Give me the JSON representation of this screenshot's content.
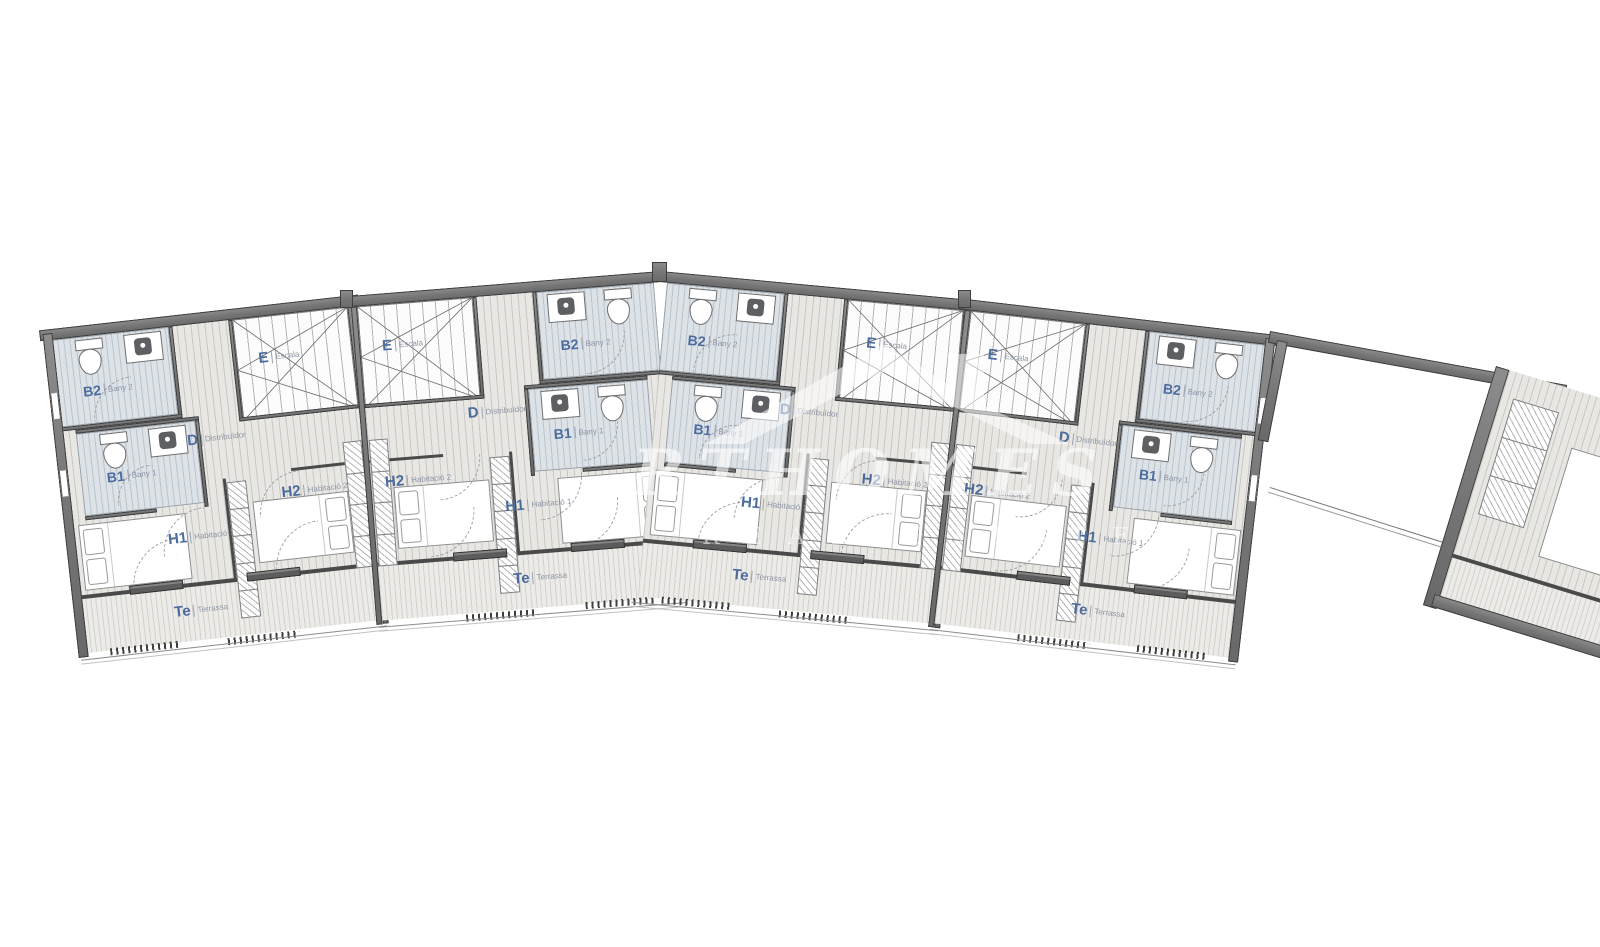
{
  "plan": {
    "type": "floor-plan",
    "language": "Catalan",
    "description": "First-floor plan of a curved row of 4 mirrored terraced houses plus a partially visible fifth unit at far right"
  },
  "watermark": {
    "logo": "house-roof-icon",
    "line1": "RTHOMES",
    "line2": "REAL ESTATE"
  },
  "colors": {
    "background": "#ffffff",
    "wall": "#757575",
    "wall_edge": "#3e3e3e",
    "floor": "#e8e7e3",
    "bathroom_floor": "#dde2e7",
    "terrace_floor": "#edebe7",
    "stairs_floor": "#fcfcfc",
    "label_code": "#4c6c9d",
    "label_name": "#8d95a5"
  },
  "units": [
    {
      "id": "unit-1",
      "mirrored": false,
      "rooms": {
        "b2": {
          "code": "B2",
          "name": "Bany 2"
        },
        "b1": {
          "code": "B1",
          "name": "Bany 1"
        },
        "d": {
          "code": "D",
          "name": "Distribuïdor"
        },
        "e": {
          "code": "E",
          "name": "Escala"
        },
        "h1": {
          "code": "H1",
          "name": "Habitació 1"
        },
        "h2": {
          "code": "H2",
          "name": "Habitació 2"
        },
        "te": {
          "code": "Te",
          "name": "Terrassa"
        }
      }
    },
    {
      "id": "unit-2",
      "mirrored": true,
      "rooms": {
        "b2": {
          "code": "B2",
          "name": "Bany 2"
        },
        "b1": {
          "code": "B1",
          "name": "Bany 1"
        },
        "d": {
          "code": "D",
          "name": "Distribuïdor"
        },
        "e": {
          "code": "E",
          "name": "Escala"
        },
        "h1": {
          "code": "H1",
          "name": "Habitació 1"
        },
        "h2": {
          "code": "H2",
          "name": "Habitació 2"
        },
        "te": {
          "code": "Te",
          "name": "Terrassa"
        }
      }
    },
    {
      "id": "unit-3",
      "mirrored": false,
      "rooms": {
        "b2": {
          "code": "B2",
          "name": "Bany 2"
        },
        "b1": {
          "code": "B1",
          "name": "Bany 1"
        },
        "d": {
          "code": "D",
          "name": "Distribuïdor"
        },
        "e": {
          "code": "E",
          "name": "Escala"
        },
        "h1": {
          "code": "H1",
          "name": "Habitació 1"
        },
        "h2": {
          "code": "H2",
          "name": "Habitació 2"
        },
        "te": {
          "code": "Te",
          "name": "Terrassa"
        }
      }
    },
    {
      "id": "unit-4",
      "mirrored": true,
      "rooms": {
        "b2": {
          "code": "B2",
          "name": "Bany 2"
        },
        "b1": {
          "code": "B1",
          "name": "Bany 1"
        },
        "d": {
          "code": "D",
          "name": "Distribuïdor"
        },
        "e": {
          "code": "E",
          "name": "Escala"
        },
        "h1": {
          "code": "H1",
          "name": "Habitació 1"
        },
        "h2": {
          "code": "H2",
          "name": "Habitació 2"
        },
        "te": {
          "code": "Te",
          "name": "Terrassa"
        }
      }
    }
  ],
  "partial_unit": {
    "id": "unit-5-partial",
    "labels_visible": false
  }
}
